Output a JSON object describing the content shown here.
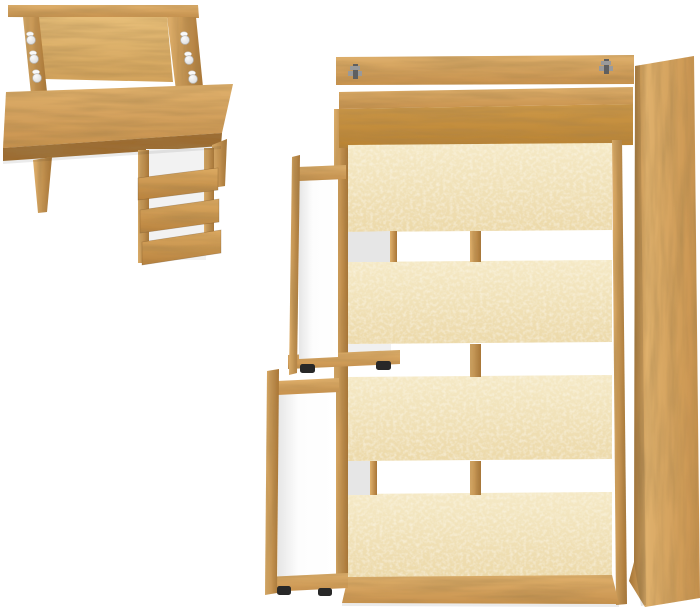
{
  "scene": {
    "description": "Product photo: oak-finish furniture set viewed from above — a writing desk with three open tilted drawers at top left, and a storage bed frame at right with four fabric-faced slat panels and two pulled-out white drawers",
    "background": "#ffffff"
  },
  "colors": {
    "wood_light": "#dfb06c",
    "wood_base": "#c8924e",
    "wood_dark": "#a87536",
    "wood_edge": "#9c6c30",
    "lid_light": "#e6bd78",
    "lid_base": "#d2a25b",
    "headboard_light": "#cd9848",
    "headboard_base": "#b98334",
    "beige_light": "#f5e9c6",
    "beige_base": "#ecd9a9",
    "front_light": "#dcaa62",
    "front_base": "#b8823e",
    "white": "#ffffff",
    "carcass_white": "#f2f2f2",
    "interior_shadow": "#e6e6e6",
    "interior_white": "#fdfdfd",
    "gap_white": "#f0f0f0",
    "hinge": "#9a9a9a",
    "hinge_dark": "#5f5f5f",
    "glide_black": "#282828",
    "knob_white": "#fafafa",
    "knob_glass": "#d9d9d9",
    "knob_ring": "#b5b5b5",
    "shadow": "rgba(0,0,0,0.08)"
  },
  "desk": {
    "open_drawers": 3,
    "knob_columns": 2,
    "knobs_per_column": 3
  },
  "bed": {
    "slat_panels": 4,
    "open_drawers": 2,
    "hinges": 2
  }
}
